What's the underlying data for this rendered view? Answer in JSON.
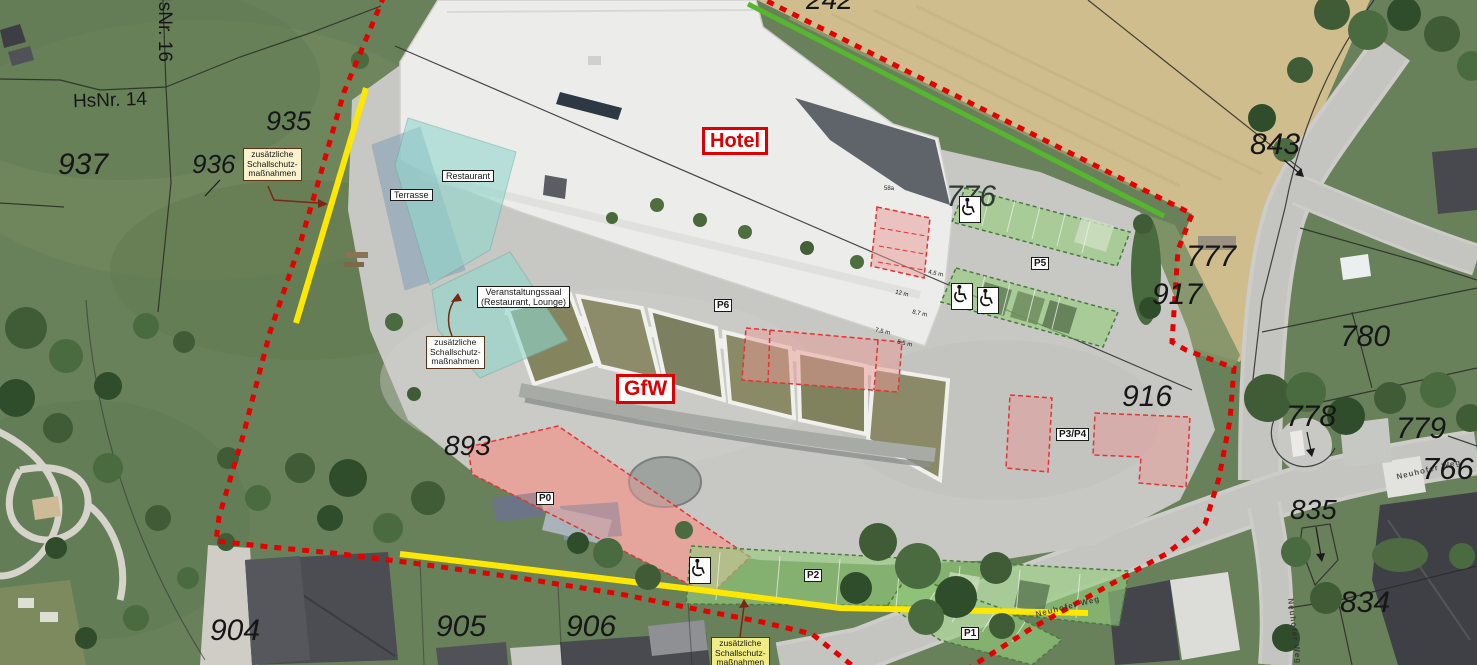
{
  "map_labels": {
    "hotel": "Hotel",
    "gfw": "GfW",
    "restaurant": "Restaurant",
    "terrasse": "Terrasse",
    "veranstaltungssaal": "Veranstaltungssaal\n(Restaurant, Lounge)",
    "schallschutz_note": "zusätzliche\nSchallschutz-\nmaßnahmen"
  },
  "parking_labels": {
    "p0": "P0",
    "p1": "P1",
    "p2": "P2",
    "p3p4": "P3/P4",
    "p5": "P5",
    "p6": "P6"
  },
  "parcel_numbers": {
    "n242": "242",
    "n766": "766",
    "n776": "776",
    "n777": "777",
    "n778": "778",
    "n779": "779",
    "n780": "780",
    "n834": "834",
    "n835": "835",
    "n843": "843",
    "n893": "893",
    "n904": "904",
    "n905": "905",
    "n906": "906",
    "n916": "916",
    "n917": "917",
    "n935": "935",
    "n936": "936",
    "n937": "937"
  },
  "house_numbers": {
    "hsnr14": "HsNr. 14",
    "hsnr16": "HsNr. 16",
    "roof_number": "58a"
  },
  "street_name": "Neuhofer Weg",
  "measurements": {
    "m1": "4,5 m",
    "m2": "12 m",
    "m3": "8,7 m",
    "m4": "7,5 m",
    "m5": "5,5 m"
  },
  "icons": {
    "wheelchair": "♿"
  },
  "colors": {
    "boundary_red": "#e50000",
    "noise_barrier_yellow": "#ffe800",
    "boundary_green": "#56b62e",
    "parking_green_overlay": "#94cd7e",
    "restricted_pink_overlay": "#e89a96",
    "building_cyan_overlay": "#91d8cd",
    "terrace_blue_overlay": "#7d9bb9",
    "plan_label_red": "#de0000"
  }
}
